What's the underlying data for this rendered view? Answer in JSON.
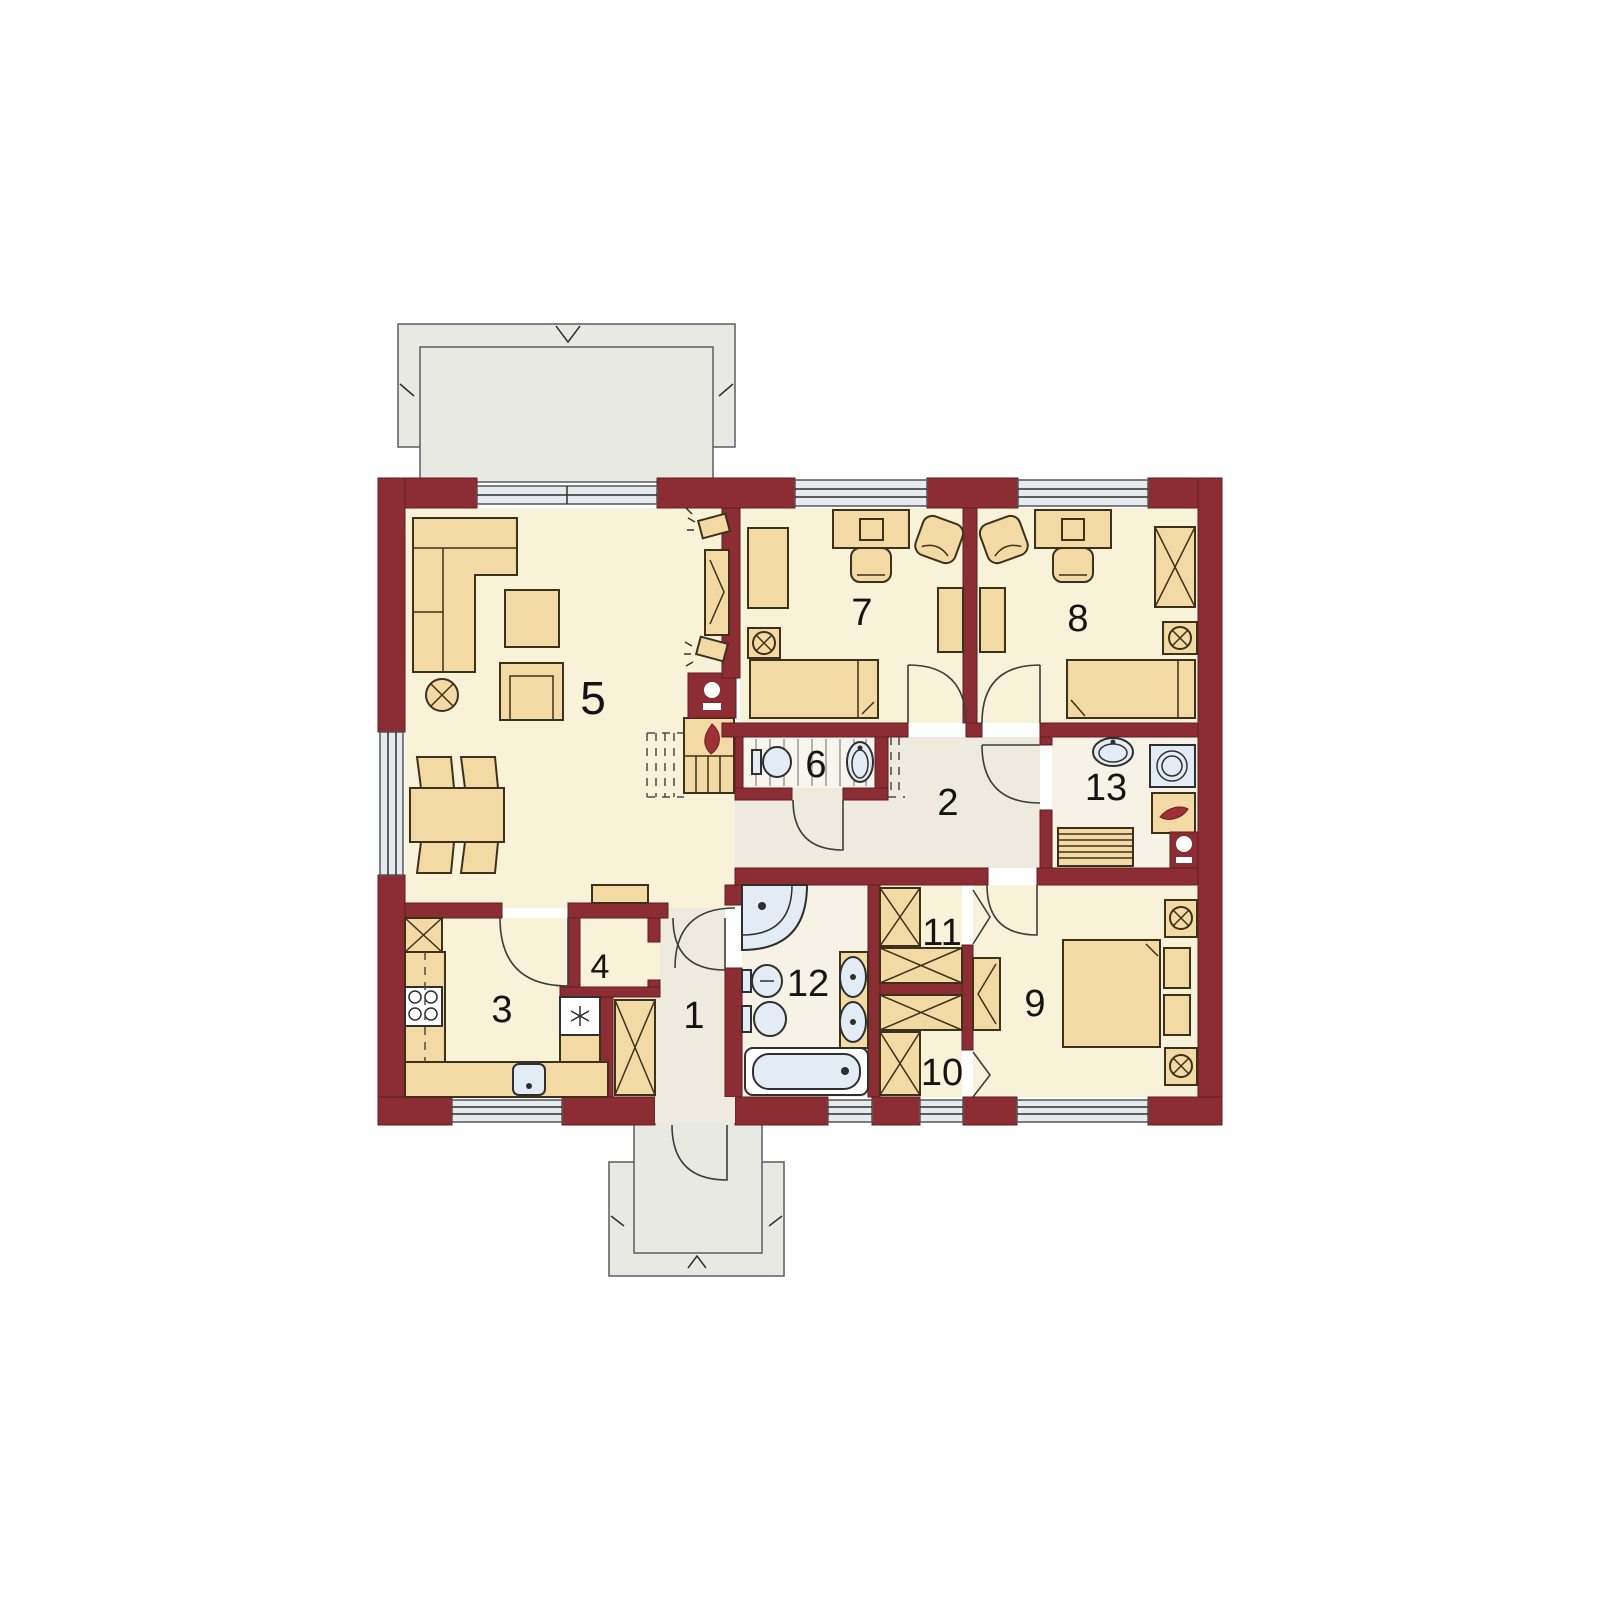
{
  "plan": {
    "type": "single-storey house floor plan",
    "room_labels": [
      "1",
      "2",
      "3",
      "4",
      "5",
      "6",
      "7",
      "8",
      "9",
      "10",
      "11",
      "12",
      "13"
    ]
  },
  "colors": {
    "wall": "#8b2d32",
    "room_floor": "#f8f2d9",
    "hall_floor": "#efeade",
    "bath_floor": "#f6f2e6",
    "furniture": "#f3d9a4",
    "fixture": "#e3ecf5",
    "terrace": "#e9e9e4",
    "flame": "#9e3038",
    "outline": "#3d311c",
    "label_text": "#141414"
  },
  "icons": {
    "flame-icon": "curved red leaf (fireplace / boiler)",
    "lamp-icon": "circle with X cross",
    "wardrobe-icon": "rectangle with X cross",
    "freezer-icon": "six point asterisk",
    "washing-machine-icon": "square with double circle",
    "chimney-icon": "dark block with white circle and bar",
    "radiator-icon": "striped rectangle",
    "mirror-icon": "chevron fan",
    "bifold-door-icon": "angled chevron lines",
    "door-swing-icon": "quarter circle arc",
    "window-icon": "triple-line glazing band",
    "stairs-icon": "parallel tread lines (dashed above cut plane)"
  }
}
